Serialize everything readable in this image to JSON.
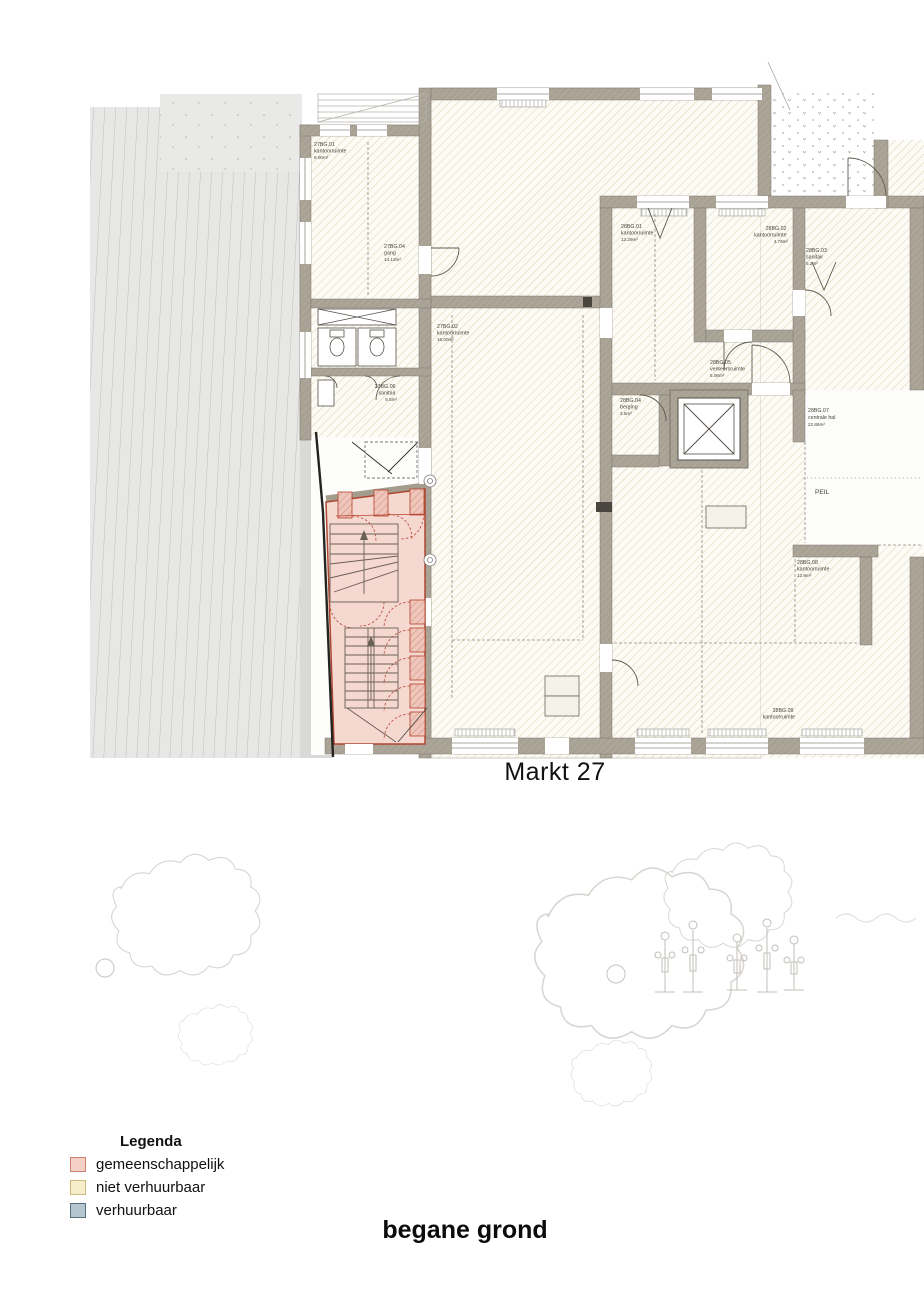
{
  "plan": {
    "street_name": "Markt 27",
    "floor_title": "begane grond",
    "datum_label": "PEIL",
    "rooms": [
      {
        "code": "27BG.01",
        "name": "kantoorruimte",
        "area": "9.00m²"
      },
      {
        "code": "27BG.04",
        "name": "gang",
        "area": "14.13m²"
      },
      {
        "code": "27BG.02",
        "name": "kantoorruimte",
        "area": "16.00m²"
      },
      {
        "code": "27BG.06",
        "name": "sanitair",
        "area": "5.5m²"
      },
      {
        "code": "28BG.01",
        "name": "kantoorruimte",
        "area": "13.29m²"
      },
      {
        "code": "28BG.02",
        "name": "kantoorruimte",
        "area": "4.79m²"
      },
      {
        "code": "28BG.03",
        "name": "sanitair",
        "area": "5.2m²"
      },
      {
        "code": "28BG.05",
        "name": "verkeersruimte",
        "area": "5.06m²"
      },
      {
        "code": "28BG.04",
        "name": "berging",
        "area": "3.5m²"
      },
      {
        "code": "28BG.07",
        "name": "centrale hal",
        "area": "22.86m²"
      },
      {
        "code": "28BG.08",
        "name": "kantoorruimte",
        "area": "12.9m²"
      },
      {
        "code": "28BG.09",
        "name": "kantoorruimte",
        "area": ""
      }
    ],
    "colors": {
      "wall": "#a8a195",
      "wall_hatch": "#beb39a",
      "room_fill": "#fdfbf5",
      "room_hatch": "#d8cda9",
      "common_fill": "#f5d8d0",
      "common_border": "#ad4731",
      "pavement": "#e7e7e5",
      "pavement_line": "#bdbdbb"
    }
  },
  "legend": {
    "title": "Legenda",
    "items": [
      {
        "label": "gemeenschappelijk",
        "fill": "#f5d0c6",
        "border": "#cc8271"
      },
      {
        "label": "niet verhuurbaar",
        "fill": "#f6eecb",
        "border": "#ccba7c"
      },
      {
        "label": "verhuurbaar",
        "fill": "#b5c6d0",
        "border": "#56707e"
      }
    ]
  }
}
